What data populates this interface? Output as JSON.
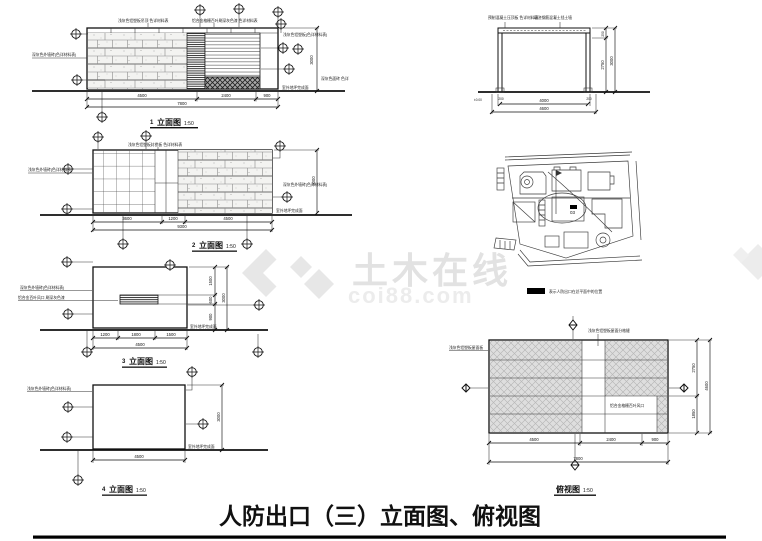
{
  "watermark": {
    "brand": "土木在线",
    "domain": "coi88.com"
  },
  "page_title": "人防出口（三）立面图、俯视图",
  "elev1": {
    "num": "1",
    "view_label": "立面图",
    "scale": "1:50",
    "ann_top_left": "浅灰色铝塑板吊顶 色详材料表",
    "ann_top_right": "铝合金格栅百叶刷深灰色漆 色详材料表",
    "ann_left": "深灰色外墙砖(色详材料表)",
    "ann_right": "浅灰色铝塑板(色详材料表)",
    "ann_right2": "深灰色面砖 色详",
    "ann_ground": "室外地坪完成面",
    "dims_bottom": [
      "4500",
      "2400",
      "900"
    ],
    "dim_total": "7800",
    "dim_right": "3000"
  },
  "elev2": {
    "num": "2",
    "view_label": "立面图",
    "scale": "1:50",
    "ann_top": "浅灰色铝塑板封檐板 色详材料表",
    "ann_left": "浅灰色外墙砖(色详材料表)",
    "ann_right": "深灰色外墙砖(色详材料表)",
    "ann_ground": "室外地坪完成面",
    "dims_bottom": [
      "3600",
      "1200",
      "4500"
    ],
    "dim_total": "9300",
    "dim_right": "3000"
  },
  "elev3": {
    "num": "3",
    "view_label": "立面图",
    "scale": "1:50",
    "ann_left1": "深灰色外墙砖(色详材料表)",
    "ann_left2": "铝合金百叶风口 刷深灰色漆",
    "ann_ground": "室外地坪完成面",
    "dims_bottom": [
      "1200",
      "1800",
      "1500"
    ],
    "dim_total": "4500",
    "dims_right": [
      "1500",
      "600",
      "900"
    ],
    "dim_right_total": "3000"
  },
  "elev4": {
    "num": "4",
    "view_label": "立面图",
    "scale": "1:50",
    "ann_left": "浅灰色外墙砖(色详材料表)",
    "ann_ground": "室外地坪完成面",
    "dim_bottom": "4500",
    "dim_right": "3000"
  },
  "section": {
    "ann_left": "预制混凝土压顶板 色详材料表",
    "ann_right": "现浇钢筋混凝土挡土墙",
    "level_note": "±0.00",
    "post_dim_left": "200",
    "post_dim_right": "200",
    "dim_inner": "4000",
    "dim_outer": "4600",
    "dim_top": "250",
    "dim_right_inner": "2750",
    "dim_right_outer": "3000"
  },
  "siteplan": {
    "building_label": "03",
    "legend_label": "表示人防出口在总平面中的位置"
  },
  "plan": {
    "view_label": "俯视图",
    "scale": "1:50",
    "ann_top": "浅灰色铝塑板屋面分格缝",
    "ann_left": "浅灰色铝塑板屋面板",
    "ann_inner": "铝合金格栅百叶风口",
    "dims_bottom": [
      "4500",
      "2400",
      "900"
    ],
    "dim_total": "7800",
    "dims_right": [
      "2750",
      "1850"
    ],
    "dim_right_total": "4600"
  }
}
